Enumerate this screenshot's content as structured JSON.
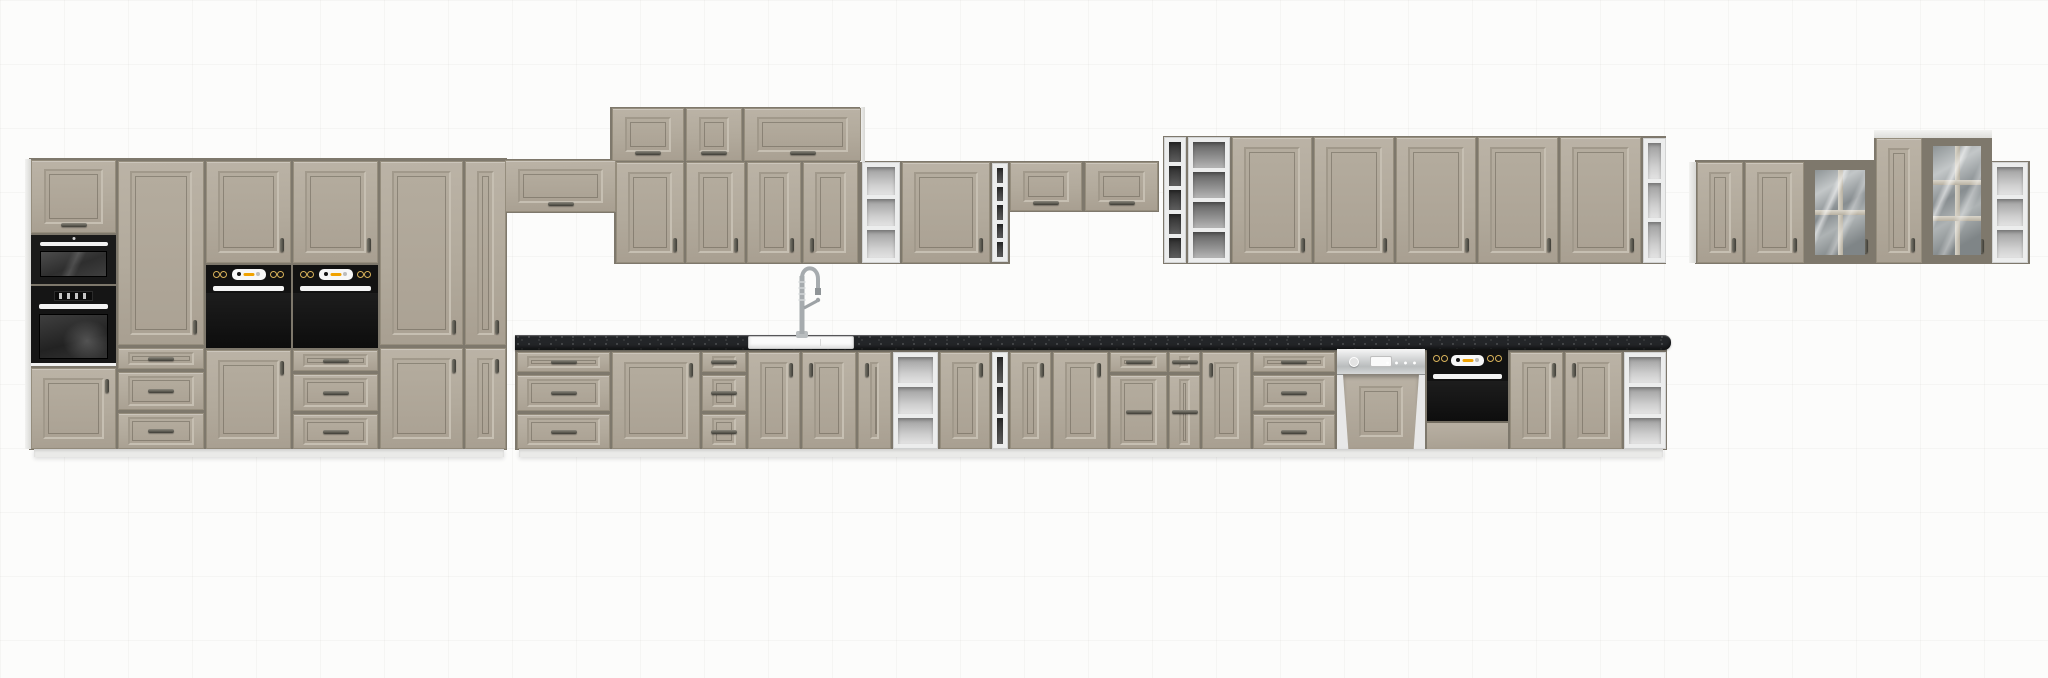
{
  "meta": {
    "subject": "kitchen-cabinet-set-product-render",
    "canvas": {
      "width": 2048,
      "height": 678
    }
  },
  "palette": {
    "background": "#fcfcfb",
    "grid_line": "#f1f0ee",
    "door": "#b3ab9d",
    "door_light": "#bbb3a6",
    "door_dark": "#a89f91",
    "mold_d": "#a1998b",
    "mold_l": "#c6bfb2",
    "seam": "#7e786c",
    "carcass_white": "#eceded",
    "interior_dark": "#3a3a3a",
    "interior_grey": "#9a9a9a",
    "interior_light": "#cfcfcf",
    "worktop": "#232528",
    "appliance_black": "#141414",
    "appliance_white": "#f4f4f4",
    "amber": "#f0a200",
    "steel": "#c4c6c7",
    "handle": "#3e3d36",
    "plinth": "#eaeae8"
  },
  "scene": {
    "units": [
      {
        "k": "backing",
        "n": "tall-section-backing",
        "x": 29,
        "y": 158,
        "w": 478,
        "h": 292
      },
      {
        "k": "backing",
        "n": "bridge-backing",
        "x": 504,
        "y": 159,
        "w": 113,
        "h": 54
      },
      {
        "k": "backing",
        "n": "top-row-backing",
        "x": 610,
        "y": 107,
        "w": 253,
        "h": 56
      },
      {
        "k": "backing",
        "n": "wall-mid-backing",
        "x": 614,
        "y": 161,
        "w": 396,
        "h": 103
      },
      {
        "k": "backing",
        "n": "wall-flip-backing",
        "x": 1008,
        "y": 161,
        "w": 151,
        "h": 51
      },
      {
        "k": "backing",
        "n": "wall-right-backing",
        "x": 1163,
        "y": 136,
        "w": 503,
        "h": 128
      },
      {
        "k": "backing",
        "n": "base-run-backing",
        "x": 515,
        "y": 349,
        "w": 1152,
        "h": 101
      },
      {
        "k": "backing",
        "n": "far-right-backing",
        "x": 1695,
        "y": 160,
        "w": 180,
        "h": 104
      },
      {
        "k": "backing",
        "n": "far-right-tall-backing",
        "x": 1874,
        "y": 137,
        "w": 118,
        "h": 127
      },
      {
        "k": "backing",
        "n": "far-right-corner-backing",
        "x": 1990,
        "y": 161,
        "w": 40,
        "h": 103
      },
      {
        "k": "side",
        "n": "tall-left-side-panel",
        "x": 25,
        "y": 159,
        "w": 6,
        "h": 290
      },
      {
        "k": "side",
        "n": "top-row-side-panel",
        "x": 860,
        "y": 107,
        "w": 5,
        "h": 55
      },
      {
        "k": "side",
        "n": "far-right-side-panel",
        "x": 1689,
        "y": 162,
        "w": 7,
        "h": 101
      },
      {
        "k": "cap",
        "n": "far-right-top-cap",
        "x": 1874,
        "y": 130,
        "w": 118,
        "h": 8
      },
      {
        "k": "flip",
        "n": "tower-top-door",
        "x": 31,
        "y": 160,
        "w": 85,
        "h": 73
      },
      {
        "k": "micro",
        "n": "built-in-microwave",
        "x": 31,
        "y": 235,
        "w": 85,
        "h": 49
      },
      {
        "k": "oven1",
        "n": "built-in-oven-tower",
        "x": 31,
        "y": 286,
        "w": 85,
        "h": 80
      },
      {
        "k": "door",
        "n": "tower-base-door",
        "h2": "tr",
        "x": 31,
        "y": 368,
        "w": 85,
        "h": 81
      },
      {
        "k": "door",
        "n": "pantry-tall-door",
        "h2": "br",
        "x": 118,
        "y": 161,
        "w": 86,
        "h": 184
      },
      {
        "k": "drawer",
        "n": "pantry-drawer-1",
        "x": 118,
        "y": 348,
        "w": 86,
        "h": 21
      },
      {
        "k": "drawer",
        "n": "pantry-drawer-2",
        "x": 118,
        "y": 372,
        "w": 86,
        "h": 38
      },
      {
        "k": "drawer",
        "n": "pantry-drawer-3",
        "x": 118,
        "y": 413,
        "w": 86,
        "h": 36
      },
      {
        "k": "door",
        "n": "oven-tower-upper-door-1",
        "h2": "br",
        "x": 206,
        "y": 161,
        "w": 85,
        "h": 102
      },
      {
        "k": "oven2",
        "n": "built-in-double-oven-1",
        "x": 206,
        "y": 265,
        "w": 85,
        "h": 83
      },
      {
        "k": "door",
        "n": "oven-tower-base-door-1",
        "h2": "tr",
        "x": 206,
        "y": 350,
        "w": 85,
        "h": 99
      },
      {
        "k": "door",
        "n": "oven-tower-upper-door-2",
        "h2": "br",
        "x": 293,
        "y": 161,
        "w": 85,
        "h": 102
      },
      {
        "k": "oven2",
        "n": "built-in-double-oven-2",
        "x": 293,
        "y": 265,
        "w": 85,
        "h": 83
      },
      {
        "k": "drawer",
        "n": "oven-tower-drawer-1",
        "x": 293,
        "y": 350,
        "w": 85,
        "h": 21
      },
      {
        "k": "drawer",
        "n": "oven-tower-drawer-2",
        "x": 293,
        "y": 374,
        "w": 85,
        "h": 37
      },
      {
        "k": "drawer",
        "n": "oven-tower-drawer-3",
        "x": 293,
        "y": 414,
        "w": 85,
        "h": 35
      },
      {
        "k": "door",
        "n": "tall-cabinet-upper-door",
        "h2": "br",
        "x": 380,
        "y": 161,
        "w": 83,
        "h": 184
      },
      {
        "k": "door",
        "n": "tall-cabinet-base-door",
        "h2": "tr",
        "x": 380,
        "y": 348,
        "w": 83,
        "h": 101
      },
      {
        "k": "door",
        "n": "tall-narrow-upper-door",
        "h2": "br",
        "x": 465,
        "y": 161,
        "w": 41,
        "h": 184
      },
      {
        "k": "door",
        "n": "tall-narrow-base-door",
        "h2": "tr",
        "x": 465,
        "y": 348,
        "w": 41,
        "h": 101
      },
      {
        "k": "flip",
        "n": "bridge-cabinet-door",
        "x": 505,
        "y": 160,
        "w": 111,
        "h": 52
      },
      {
        "k": "flip",
        "n": "top-cabinet-door-1",
        "x": 612,
        "y": 108,
        "w": 72,
        "h": 53
      },
      {
        "k": "flip",
        "n": "top-cabinet-door-2",
        "x": 686,
        "y": 108,
        "w": 56,
        "h": 53
      },
      {
        "k": "flip",
        "n": "top-cabinet-door-3",
        "x": 744,
        "y": 108,
        "w": 117,
        "h": 53
      },
      {
        "k": "door",
        "n": "wall-door-1",
        "h2": "br",
        "x": 616,
        "y": 162,
        "w": 68,
        "h": 101
      },
      {
        "k": "door",
        "n": "wall-door-2",
        "h2": "br",
        "x": 686,
        "y": 162,
        "w": 59,
        "h": 101
      },
      {
        "k": "door",
        "n": "wall-door-3",
        "h2": "br",
        "x": 747,
        "y": 162,
        "w": 54,
        "h": 101
      },
      {
        "k": "door",
        "n": "wall-door-4",
        "h2": "bl",
        "x": 803,
        "y": 162,
        "w": 55,
        "h": 101
      },
      {
        "k": "shelf",
        "n": "wall-open-shelf",
        "tone": "light",
        "cells": 3,
        "x": 862,
        "y": 162,
        "w": 38,
        "h": 101
      },
      {
        "k": "door",
        "n": "wall-door-5",
        "h2": "br",
        "x": 902,
        "y": 162,
        "w": 88,
        "h": 101
      },
      {
        "k": "shelf",
        "n": "wall-rack-narrow-1",
        "tone": "dark",
        "cells": 5,
        "x": 992,
        "y": 163,
        "w": 16,
        "h": 99
      },
      {
        "k": "flip",
        "n": "wall-flip-door-1",
        "x": 1010,
        "y": 162,
        "w": 72,
        "h": 49
      },
      {
        "k": "flip",
        "n": "wall-flip-door-2",
        "x": 1085,
        "y": 162,
        "w": 73,
        "h": 49
      },
      {
        "k": "shelf",
        "n": "wall-rack-narrow-2",
        "tone": "dark",
        "cells": 5,
        "x": 1164,
        "y": 137,
        "w": 22,
        "h": 126
      },
      {
        "k": "shelf",
        "n": "wall-rack-wide",
        "tone": "grey",
        "cells": 4,
        "x": 1188,
        "y": 137,
        "w": 42,
        "h": 126
      },
      {
        "k": "door",
        "n": "wall-tall-door-1",
        "h2": "br",
        "x": 1232,
        "y": 137,
        "w": 80,
        "h": 126
      },
      {
        "k": "door",
        "n": "wall-tall-door-2",
        "h2": "br",
        "x": 1314,
        "y": 137,
        "w": 80,
        "h": 126
      },
      {
        "k": "door",
        "n": "wall-tall-door-3",
        "h2": "br",
        "x": 1396,
        "y": 137,
        "w": 80,
        "h": 126
      },
      {
        "k": "door",
        "n": "wall-tall-door-4",
        "h2": "br",
        "x": 1478,
        "y": 137,
        "w": 80,
        "h": 126
      },
      {
        "k": "door",
        "n": "wall-tall-door-5",
        "h2": "br",
        "x": 1560,
        "y": 137,
        "w": 81,
        "h": 126
      },
      {
        "k": "shelf",
        "n": "wall-corner-shelf",
        "tone": "light",
        "cells": 3,
        "x": 1643,
        "y": 138,
        "w": 23,
        "h": 125
      },
      {
        "k": "counter",
        "n": "worktop",
        "x": 515,
        "y": 335,
        "w": 1156,
        "h": 15
      },
      {
        "k": "sink",
        "n": "sink",
        "x": 748,
        "y": 336,
        "w": 106,
        "h": 13
      },
      {
        "k": "faucet",
        "n": "faucet",
        "x": 778,
        "y": 250,
        "w": 46,
        "h": 88
      },
      {
        "k": "drawer",
        "n": "base-drawer-a1",
        "x": 517,
        "y": 352,
        "w": 93,
        "h": 20
      },
      {
        "k": "drawer",
        "n": "base-drawer-a2",
        "x": 517,
        "y": 375,
        "w": 93,
        "h": 36
      },
      {
        "k": "drawer",
        "n": "base-drawer-a3",
        "x": 517,
        "y": 414,
        "w": 93,
        "h": 35
      },
      {
        "k": "door",
        "n": "base-door-a",
        "h2": "tr",
        "x": 612,
        "y": 352,
        "w": 88,
        "h": 97
      },
      {
        "k": "drawer",
        "n": "base-drawer-b1",
        "x": 702,
        "y": 352,
        "w": 44,
        "h": 20
      },
      {
        "k": "drawer",
        "n": "base-drawer-b2",
        "x": 702,
        "y": 375,
        "w": 44,
        "h": 36
      },
      {
        "k": "drawer",
        "n": "base-drawer-b3",
        "x": 702,
        "y": 414,
        "w": 44,
        "h": 35
      },
      {
        "k": "door",
        "n": "sink-base-door-left",
        "h2": "tr",
        "x": 748,
        "y": 352,
        "w": 52,
        "h": 97
      },
      {
        "k": "door",
        "n": "sink-base-door-right",
        "h2": "tl",
        "x": 802,
        "y": 352,
        "w": 54,
        "h": 97
      },
      {
        "k": "door",
        "n": "base-door-b",
        "h2": "tl",
        "x": 858,
        "y": 352,
        "w": 33,
        "h": 97
      },
      {
        "k": "shelf",
        "n": "base-open-shelf",
        "tone": "light",
        "cells": 3,
        "x": 893,
        "y": 352,
        "w": 45,
        "h": 97
      },
      {
        "k": "door",
        "n": "base-door-c",
        "h2": "tr",
        "x": 940,
        "y": 352,
        "w": 50,
        "h": 97
      },
      {
        "k": "shelf",
        "n": "base-rack-narrow",
        "tone": "dark",
        "cells": 3,
        "x": 992,
        "y": 352,
        "w": 16,
        "h": 97
      },
      {
        "k": "door",
        "n": "base-door-d",
        "h2": "tr",
        "x": 1010,
        "y": 352,
        "w": 41,
        "h": 97
      },
      {
        "k": "door",
        "n": "base-door-e",
        "h2": "tr",
        "x": 1053,
        "y": 352,
        "w": 55,
        "h": 97
      },
      {
        "k": "drawer",
        "n": "base-drawer-c1",
        "x": 1110,
        "y": 352,
        "w": 57,
        "h": 20
      },
      {
        "k": "drawer",
        "n": "base-drawer-c2",
        "x": 1110,
        "y": 375,
        "w": 57,
        "h": 74
      },
      {
        "k": "drawer",
        "n": "base-drawer-d1",
        "x": 1169,
        "y": 352,
        "w": 31,
        "h": 20
      },
      {
        "k": "drawer",
        "n": "base-drawer-d2",
        "x": 1169,
        "y": 375,
        "w": 31,
        "h": 74
      },
      {
        "k": "door",
        "n": "base-door-f",
        "h2": "tl",
        "x": 1202,
        "y": 352,
        "w": 49,
        "h": 97
      },
      {
        "k": "drawer",
        "n": "base-drawer-e1",
        "x": 1253,
        "y": 352,
        "w": 82,
        "h": 20
      },
      {
        "k": "drawer",
        "n": "base-drawer-e2",
        "x": 1253,
        "y": 375,
        "w": 82,
        "h": 36
      },
      {
        "k": "drawer",
        "n": "base-drawer-e3",
        "x": 1253,
        "y": 414,
        "w": 82,
        "h": 35
      },
      {
        "k": "dw",
        "n": "dishwasher",
        "x": 1337,
        "y": 349,
        "w": 88,
        "h": 100
      },
      {
        "k": "oven2",
        "n": "built-in-oven-undercounter",
        "foot": 26,
        "ch": 22,
        "x": 1427,
        "y": 349,
        "w": 81,
        "h": 100
      },
      {
        "k": "door",
        "n": "base-door-g",
        "h2": "tr",
        "x": 1510,
        "y": 352,
        "w": 53,
        "h": 97
      },
      {
        "k": "door",
        "n": "base-door-h",
        "h2": "tl",
        "x": 1565,
        "y": 352,
        "w": 57,
        "h": 97
      },
      {
        "k": "shelf",
        "n": "base-corner-shelf",
        "tone": "light",
        "cells": 3,
        "x": 1624,
        "y": 352,
        "w": 42,
        "h": 97
      },
      {
        "k": "plinth",
        "n": "plinth-left",
        "x": 34,
        "y": 449,
        "w": 470,
        "h": 8
      },
      {
        "k": "plinth",
        "n": "plinth-main",
        "x": 519,
        "y": 449,
        "w": 1144,
        "h": 8
      },
      {
        "k": "door",
        "n": "far-right-wall-door-1",
        "h2": "br",
        "x": 1697,
        "y": 162,
        "w": 46,
        "h": 101
      },
      {
        "k": "door",
        "n": "far-right-wall-door-2",
        "h2": "br",
        "x": 1745,
        "y": 162,
        "w": 59,
        "h": 101
      },
      {
        "k": "glass",
        "n": "far-right-glass-door-1",
        "h2": "br",
        "cols": 2,
        "rows": 2,
        "x": 1806,
        "y": 162,
        "w": 68,
        "h": 101
      },
      {
        "k": "door",
        "n": "far-right-wall-door-3",
        "h2": "br",
        "x": 1876,
        "y": 138,
        "w": 46,
        "h": 125
      },
      {
        "k": "glass",
        "n": "far-right-glass-door-2",
        "h2": "br",
        "cols": 2,
        "rows": 3,
        "x": 1924,
        "y": 138,
        "w": 66,
        "h": 125
      },
      {
        "k": "shelf",
        "n": "far-right-corner-shelf",
        "tone": "light",
        "cells": 3,
        "x": 1992,
        "y": 162,
        "w": 36,
        "h": 101
      }
    ]
  }
}
